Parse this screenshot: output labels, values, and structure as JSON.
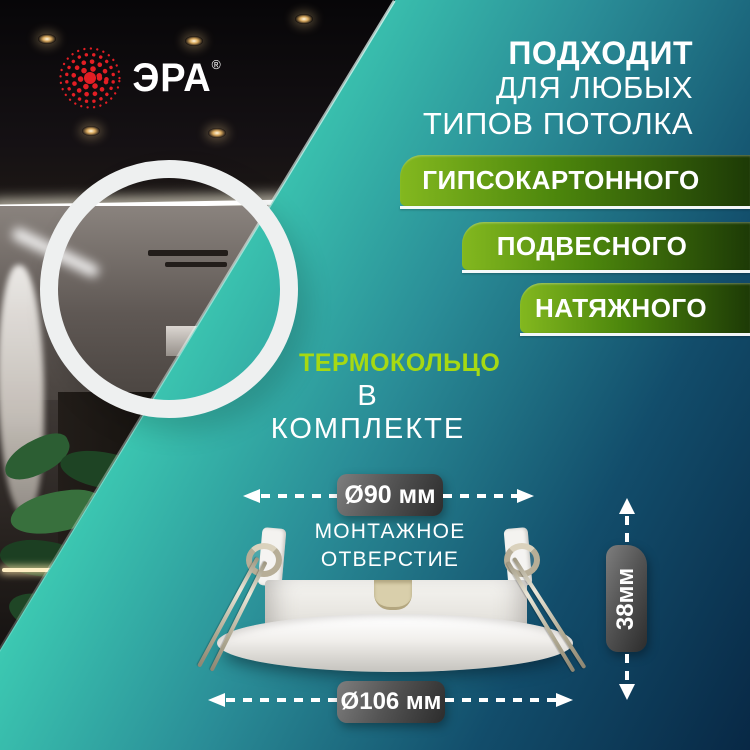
{
  "brand": {
    "name": "ЭРА",
    "registered_mark": "®"
  },
  "headline": {
    "line1": "ПОДХОДИТ",
    "line2": "ДЛЯ ЛЮБЫХ",
    "line3": "ТИПОВ ПОТОЛКА"
  },
  "ceiling_types": [
    {
      "label": "ГИПСОКАРТОННОГО"
    },
    {
      "label": "ПОДВЕСНОГО"
    },
    {
      "label": "НАТЯЖНОГО"
    }
  ],
  "feature": {
    "name": "ТЕРМОКОЛЬЦО",
    "note": "В КОМПЛЕКТЕ"
  },
  "dimensions": {
    "mounting_hole": {
      "label": "Ø90 мм",
      "caption_line1": "МОНТАЖНОЕ",
      "caption_line2": "ОТВЕРСТИЕ"
    },
    "outer_diameter": {
      "label": "Ø106 мм"
    },
    "height": {
      "label": "38мм"
    }
  },
  "colors": {
    "brand_red": "#e31e24",
    "banner_green_light": "#83b81f",
    "banner_green_dark": "#1d3a06",
    "feature_green": "#a6d912",
    "background_teal": "#3cc9b2",
    "background_navy": "#082845",
    "badge_gray": "#555555"
  }
}
